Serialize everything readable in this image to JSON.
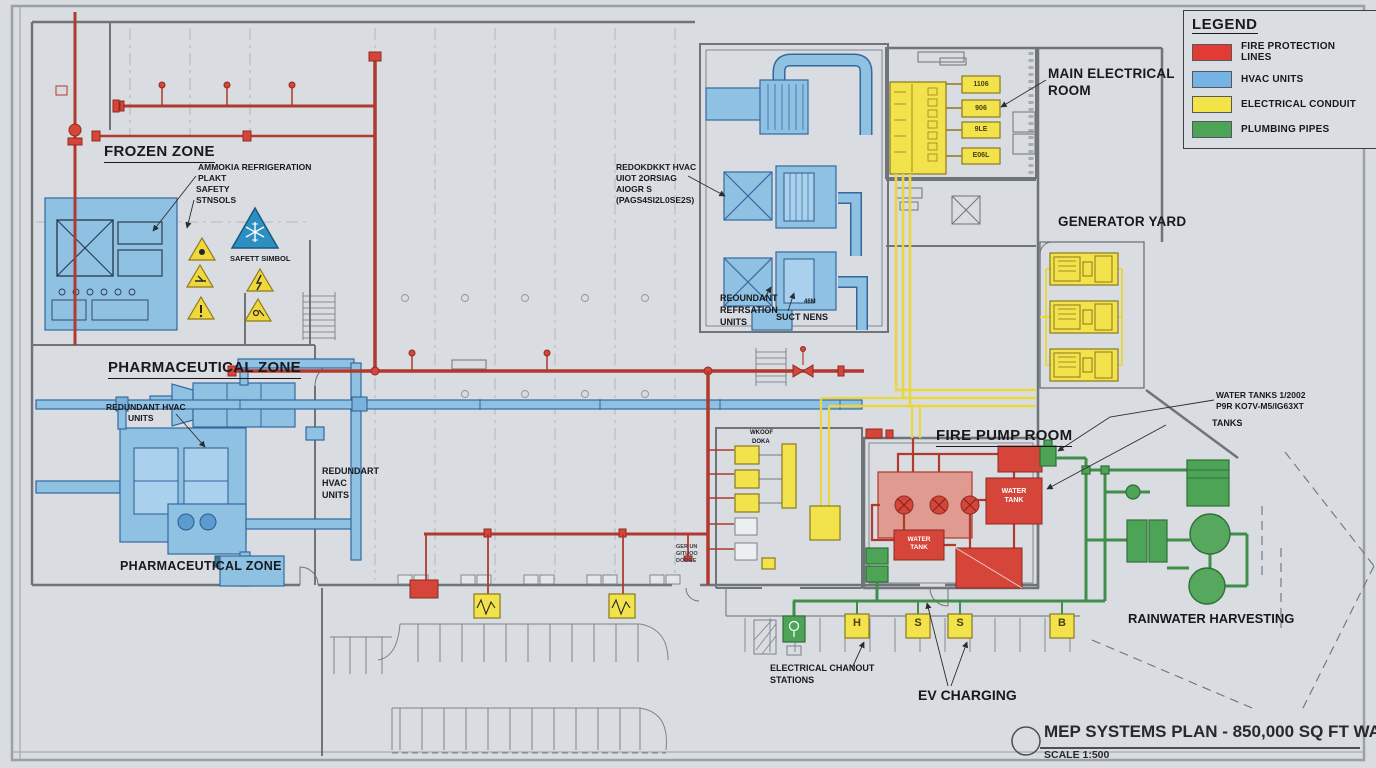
{
  "sheet": {
    "background": "#d9dce1",
    "frame_color": "#9ba0a7"
  },
  "colors": {
    "fire": "#d6453a",
    "hvac": "#8fc1e3",
    "electrical": "#f2e24b",
    "plumbing": "#4da457"
  },
  "legend": {
    "title": "LEGEND",
    "items": [
      {
        "label": "FIRE PROTECTION LINES",
        "color": "#e23b33"
      },
      {
        "label": "HVAC UNITS",
        "color": "#74b3e4"
      },
      {
        "label": "ELECTRICAL CONDUIT",
        "color": "#f2e446"
      },
      {
        "label": "PLUMBING PIPES",
        "color": "#4da457"
      }
    ]
  },
  "zones": {
    "frozen": "FROZEN ZONE",
    "pharma": "PHARMACEUTICAL ZONE",
    "pharma2": "PHARMACEUTICAL ZONE",
    "electrical": [
      "MAIN ELECTRICAL",
      "ROOM"
    ],
    "generator": "GENERATOR YARD",
    "fire_pump": "FIRE PUMP ROOM",
    "rainwater": "RAINWATER HARVESTING",
    "ev": "EV CHARGING"
  },
  "annotations": {
    "ammonia": [
      "AMMOKIA REFRIGERATION",
      "PLAKT"
    ],
    "safety": [
      "SAFETY",
      "STNSOLS"
    ],
    "safety_symbol": "SAFETT SIMBOL",
    "hvac_left": [
      "REDUNDANT HVAC",
      "UNITS"
    ],
    "hvac_right": [
      "REDUNDART",
      "HVAC",
      "UNITS"
    ],
    "rooftop": [
      "REDOKDKKT HVAC",
      "UIOT 2ORSIAG",
      "AIOGR S",
      "(PAGS4SI2L0SE2S)"
    ],
    "refrigeration": [
      "REOUNDANT",
      "REFRSATION",
      "UNITS"
    ],
    "duct_mains": "SUCT NENS",
    "duct_tag": "46M",
    "water_note": [
      "WATER TANKS 1/2002",
      "P9R KO7V-M5/IG63XT"
    ],
    "tanks": "TANKS",
    "chanout": [
      "ELECTRICAL CHANOUT",
      "STATIONS"
    ],
    "room_note": [
      "WKOOF",
      "DOKA"
    ],
    "door_note": [
      "GER UN",
      "GITUOO",
      "DOOGE"
    ]
  },
  "equipment_tags": {
    "panel": [
      "1106",
      "906",
      "9LE",
      "E06L"
    ],
    "tank_large": [
      "WATER",
      "TANK"
    ],
    "tank_small": [
      "WATER",
      "TANK"
    ],
    "ev_units": [
      "H",
      "S",
      "S",
      "B"
    ]
  },
  "title_block": {
    "title": "MEP SYSTEMS PLAN - 850,000 SQ FT WAREHOUSE",
    "scale": "SCALE 1:500"
  }
}
